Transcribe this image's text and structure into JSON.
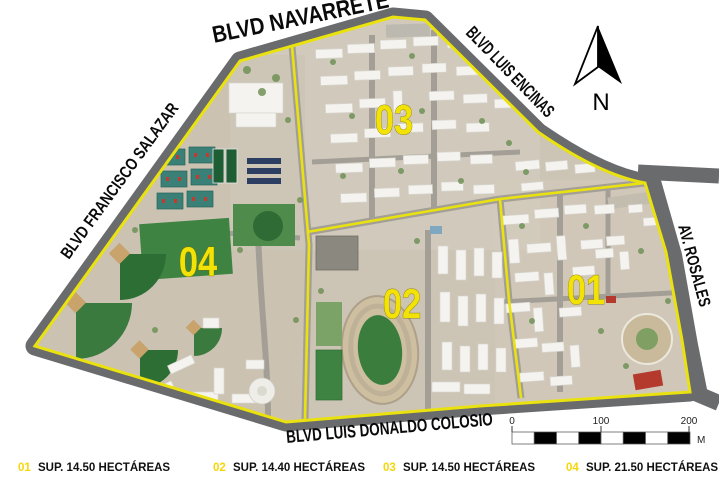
{
  "figure": {
    "type": "campus-zoning-aerial-map",
    "streets": {
      "navarrete": "BLVD NAVARRETE",
      "luis_encinas": "BLVD LUIS ENCINAS",
      "francisco_salazar": "BLVD FRANCISCO SALAZAR",
      "rosales": "AV. ROSALES",
      "colosio": "BLVD LUIS DONALDO COLOSIO"
    },
    "zones": {
      "z01": "01",
      "z02": "02",
      "z03": "03",
      "z04": "04"
    },
    "legend": {
      "items": [
        {
          "number": "01",
          "label": "SUP. 14.50 HECTÁREAS"
        },
        {
          "number": "02",
          "label": "SUP. 14.40 HECTÁREAS"
        },
        {
          "number": "03",
          "label": "SUP. 14.50 HECTÁREAS"
        },
        {
          "number": "04",
          "label": "SUP. 21.50 HECTÁREAS"
        }
      ]
    },
    "north_arrow": {
      "label": "N"
    },
    "scale_bar": {
      "tick_0": "0",
      "tick_100": "100",
      "tick_200": "200",
      "unit": "M"
    },
    "colors": {
      "boundary_yellow": "#eae20f",
      "zone_label_yellow": "#f2e206",
      "legend_number_yellow": "#f6d60a",
      "road_gray": "#6a6b6d",
      "terrain_tan": "#ccc4b4",
      "field_green": "#3e8342",
      "stadium_green": "#3a7d3c",
      "court_teal": "#3a8076",
      "parking_navy": "#2c3f63",
      "infield_tan": "#c8a36b",
      "red_roof": "#b43a2d"
    }
  }
}
